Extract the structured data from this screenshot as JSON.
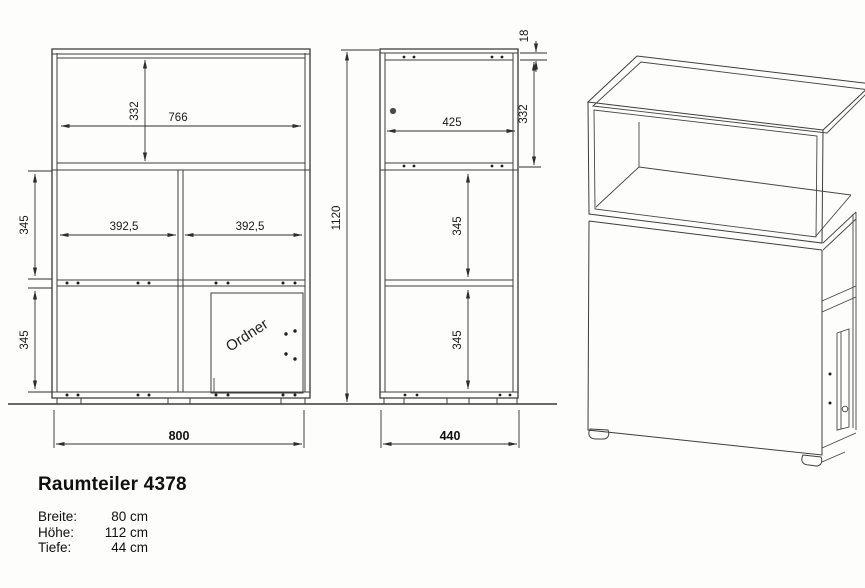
{
  "drawing": {
    "title": "Raumteiler 4378",
    "specs": [
      {
        "label": "Breite:",
        "value": "80 cm"
      },
      {
        "label": "Höhe:",
        "value": "112 cm"
      },
      {
        "label": "Tiefe:",
        "value": "44 cm"
      }
    ],
    "front_view": {
      "dim_top_inner_height": "332",
      "dim_top_inner_width": "766",
      "dim_middle_row_height": "345",
      "dim_left_compartment_width": "392,5",
      "dim_right_compartment_width": "392,5",
      "dim_bottom_row_height": "345",
      "dim_total_width": "800",
      "door_label": "Ordner"
    },
    "side_view": {
      "dim_top_panel_thickness": "18",
      "dim_top_inner_height": "332",
      "dim_inner_depth": "425",
      "dim_middle_row_height": "345",
      "dim_bottom_row_height": "345",
      "dim_total_height": "1120",
      "dim_total_depth": "440"
    },
    "colors": {
      "line": "#383838",
      "background": "#fdfdfc"
    }
  }
}
